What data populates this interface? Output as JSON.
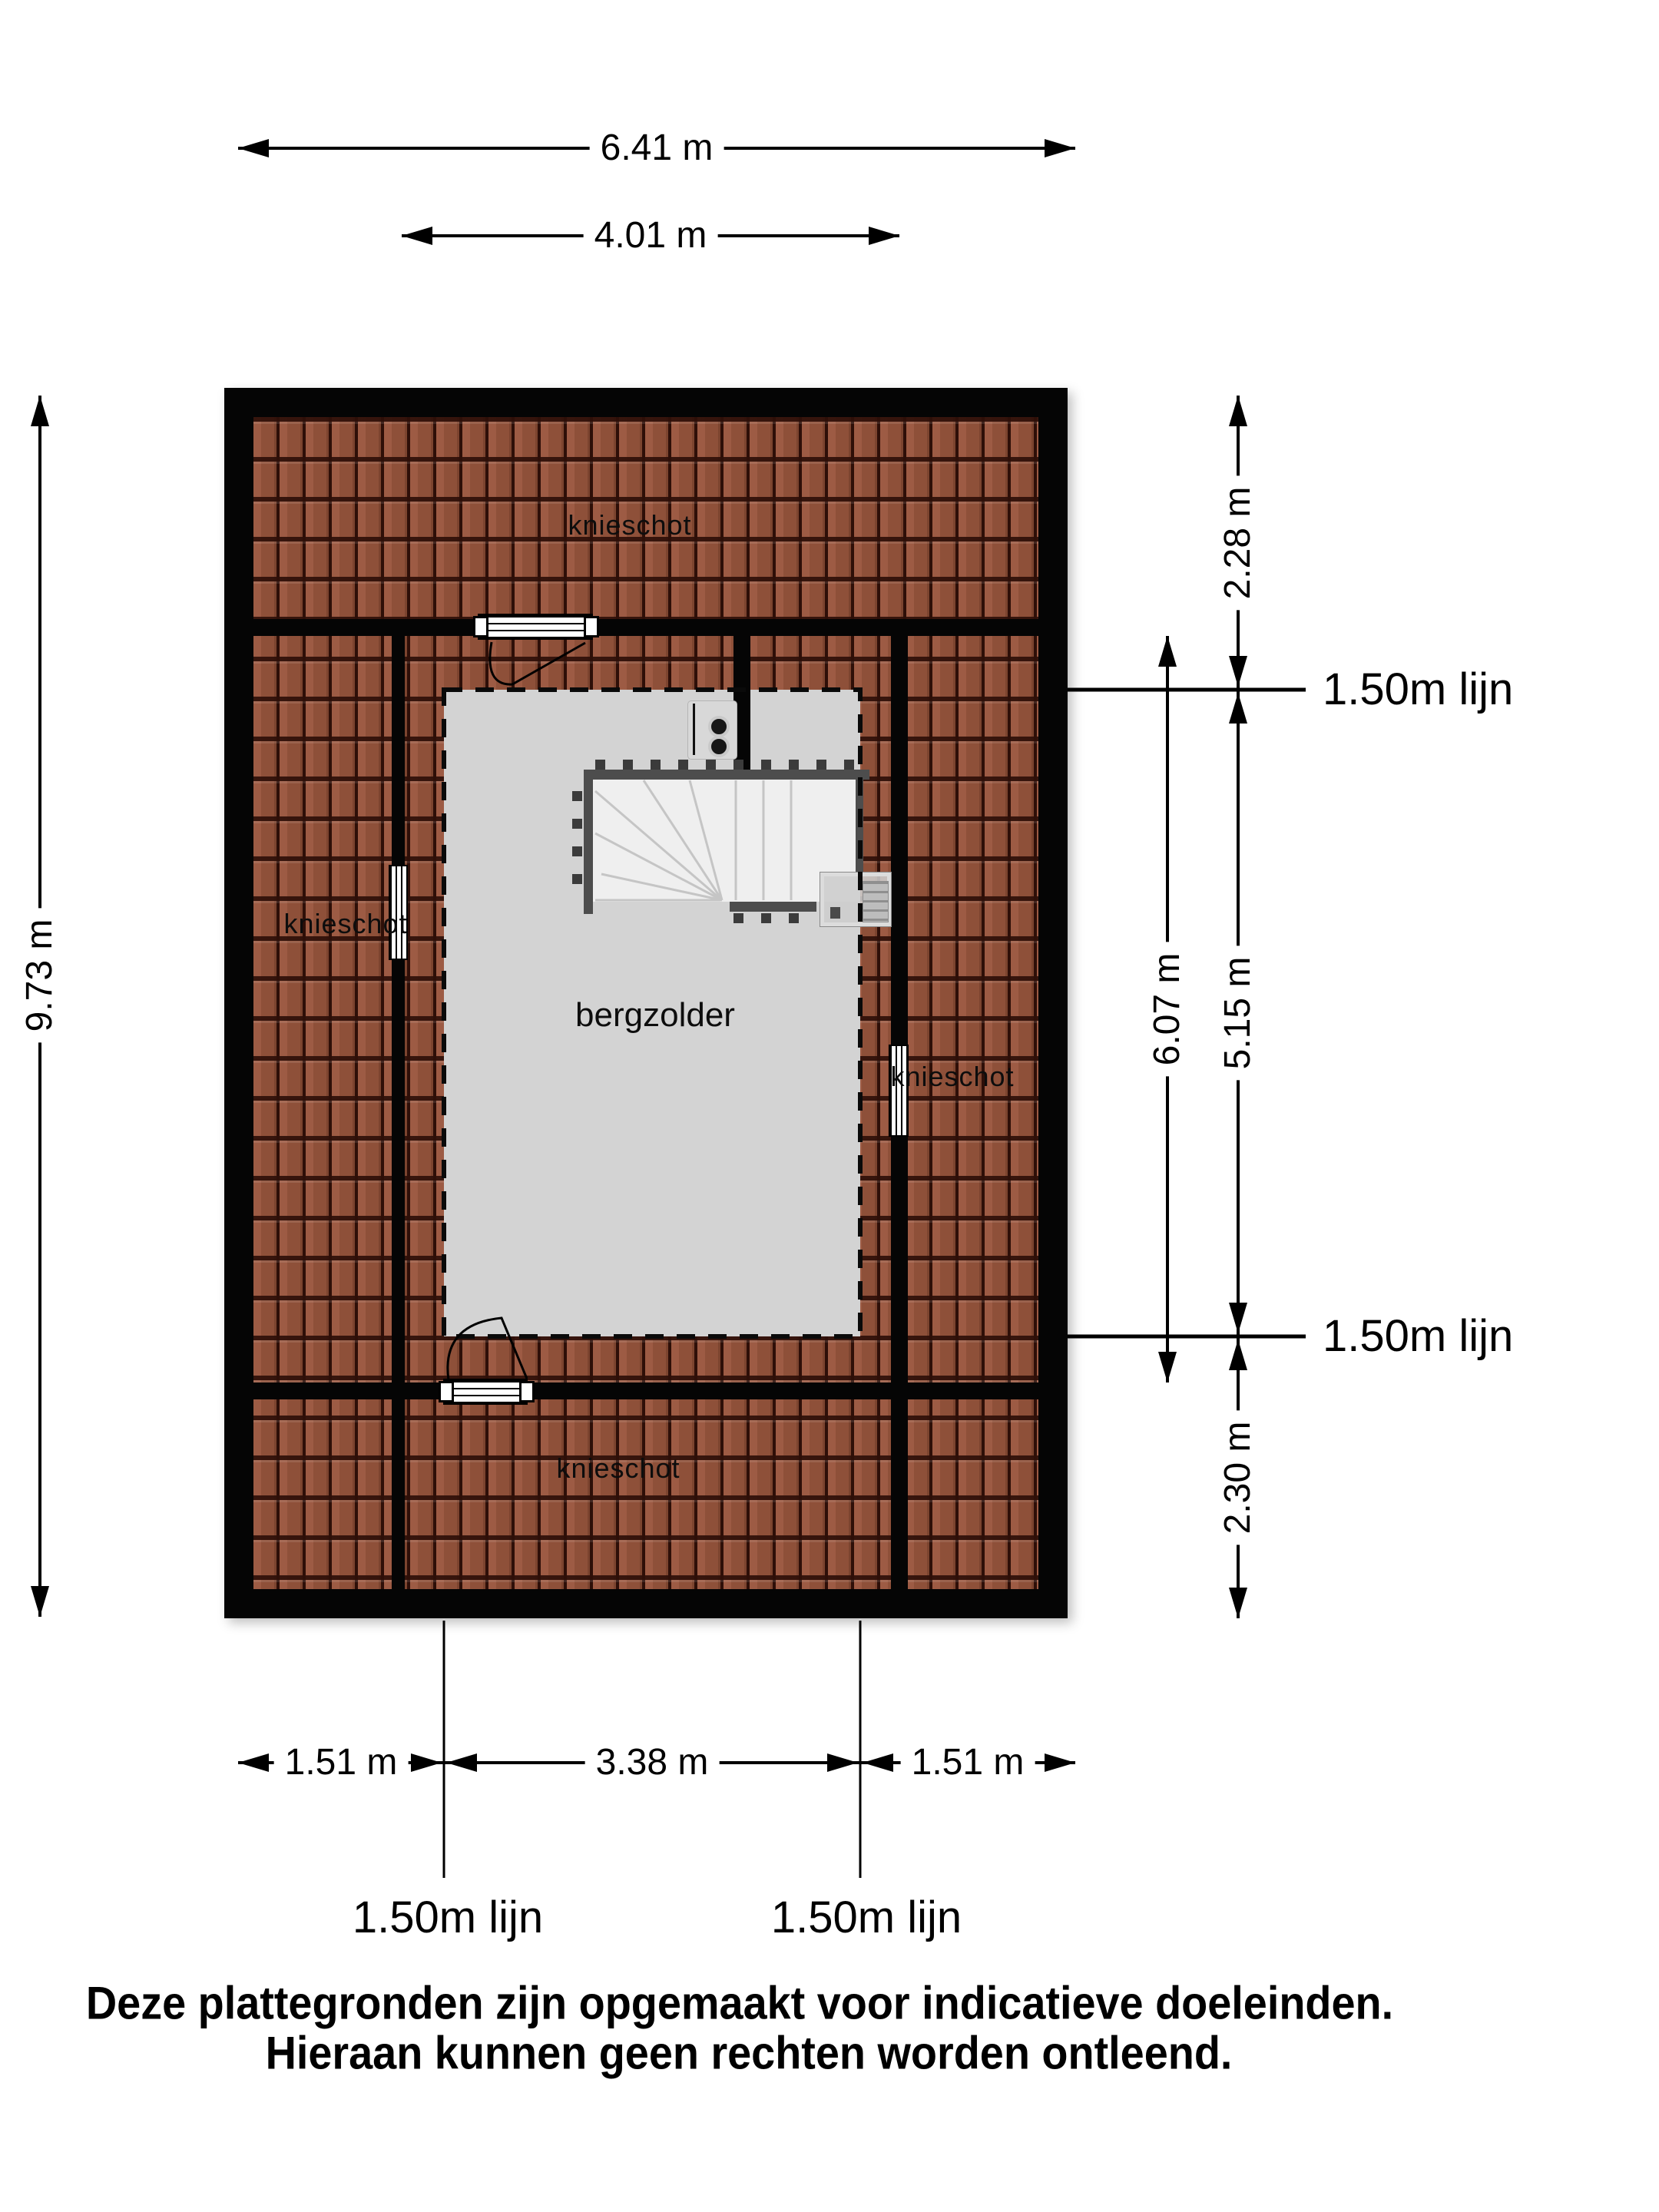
{
  "document": {
    "type": "floor-plan-attic"
  },
  "plan": {
    "room_label": "bergzolder",
    "knee_wall_labels": {
      "top": "knieschot",
      "left": "knieschot",
      "right": "knieschot",
      "bottom": "knieschot"
    }
  },
  "dimensions": {
    "top_outer": "6.41 m",
    "top_inner": "4.01 m",
    "left": "9.73 m",
    "right_top": "2.28 m",
    "right_inner": "6.07 m",
    "right_middle": "5.15 m",
    "right_bottom": "2.30 m",
    "bottom_left": "1.51 m",
    "bottom_middle": "3.38 m",
    "bottom_right": "1.51 m"
  },
  "height_lines": {
    "right_top": "1.50m lijn",
    "right_bottom": "1.50m lijn",
    "bottom_left": "1.50m lijn",
    "bottom_right": "1.50m lijn"
  },
  "footer": {
    "line1": "Deze plattegronden zijn opgemaakt voor indicatieve doeleinden.",
    "line2": "Hieraan kunnen geen rechten worden ontleend."
  },
  "colors": {
    "background": "#ffffff",
    "wall": "#050505",
    "roof_tile": "#93543d",
    "roof_tile_gap": "#2e0f08",
    "floor_gray": "#d3d3d3",
    "stairs": "#efefef",
    "railing": "#4d4d4d",
    "line": "#000000"
  }
}
